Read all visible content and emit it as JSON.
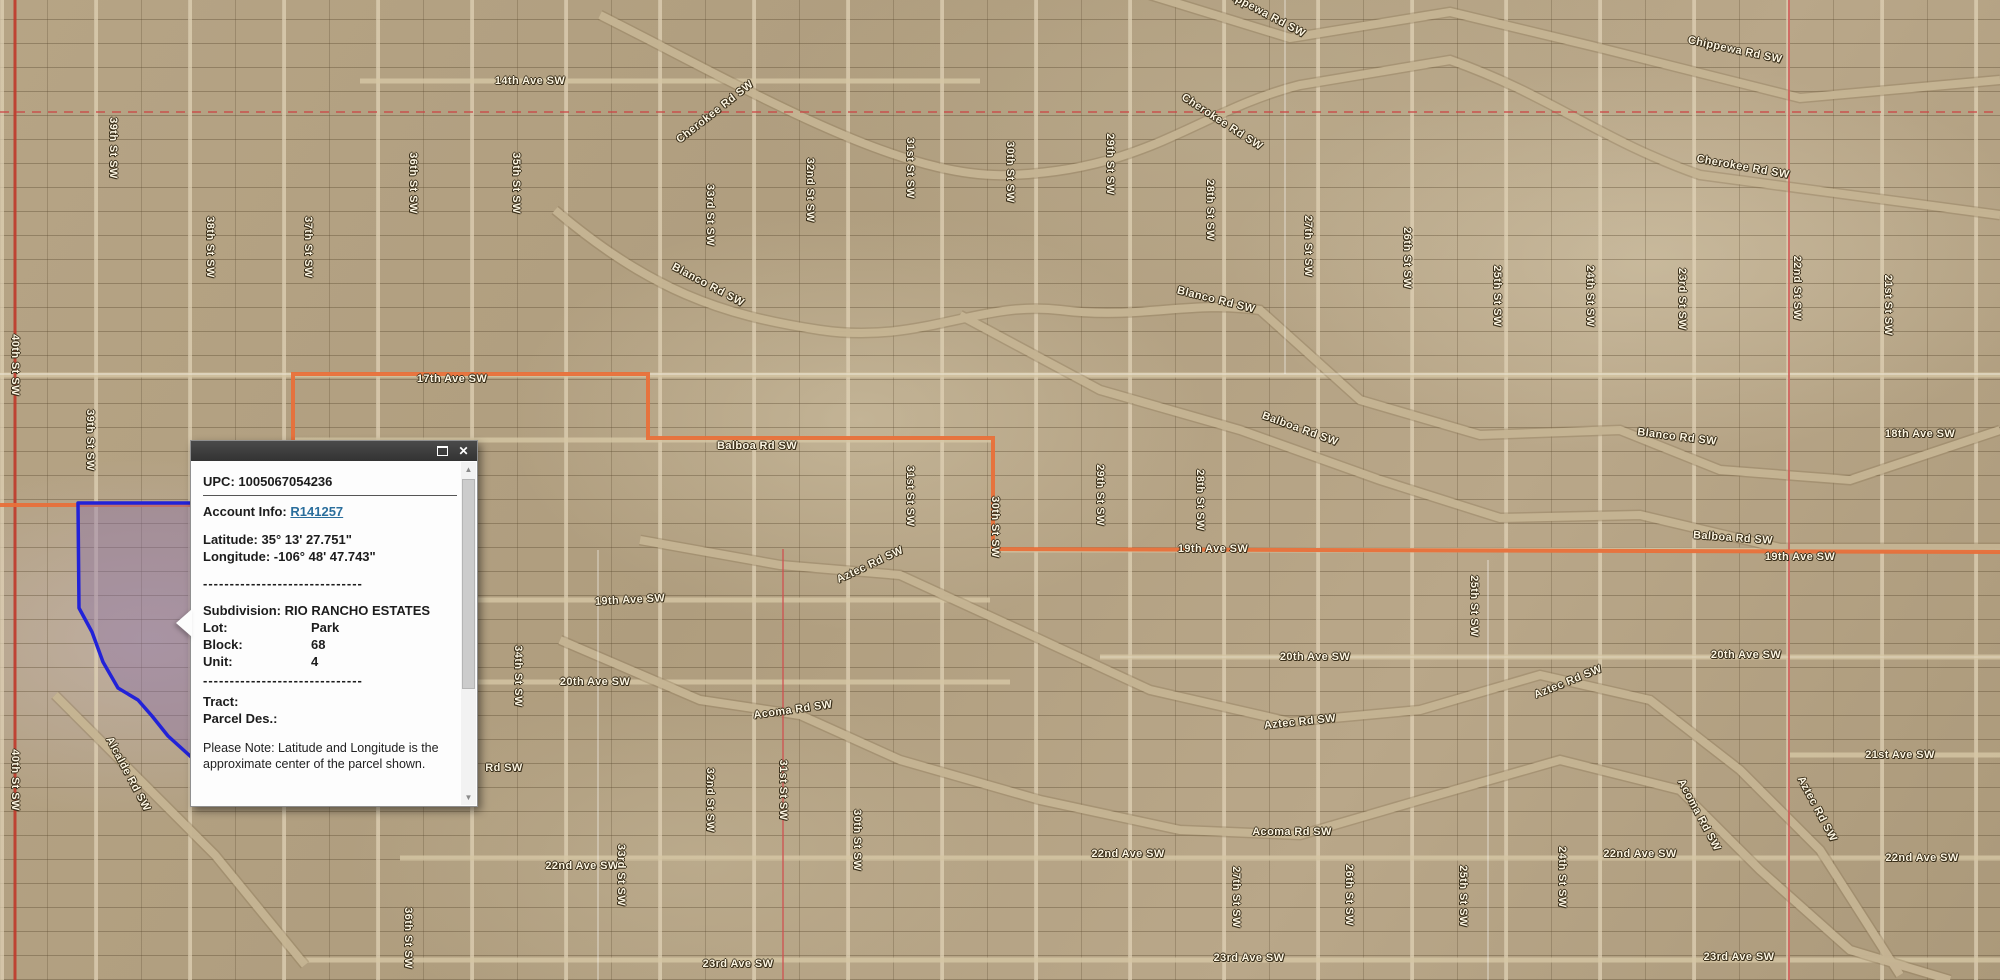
{
  "map": {
    "colors": {
      "parcel_outline_blue": "#2222d8",
      "parcel_fill_purple": "rgba(138,112,168,0.42)",
      "boundary_orange": "#e8703a",
      "section_line_red": "#cc4040",
      "road_red": "#c0392b",
      "label_text": "#fdf6e3"
    },
    "street_labels": [
      {
        "text": "39th St SW",
        "x": 113,
        "y": 148,
        "r": 90
      },
      {
        "text": "38th St SW",
        "x": 210,
        "y": 247,
        "r": 90
      },
      {
        "text": "37th St SW",
        "x": 308,
        "y": 247,
        "r": 90
      },
      {
        "text": "36th St SW",
        "x": 413,
        "y": 183,
        "r": 90
      },
      {
        "text": "35th St SW",
        "x": 516,
        "y": 183,
        "r": 90
      },
      {
        "text": "33rd St SW",
        "x": 710,
        "y": 215,
        "r": 90
      },
      {
        "text": "32nd St SW",
        "x": 810,
        "y": 190,
        "r": 90
      },
      {
        "text": "31st St SW",
        "x": 910,
        "y": 168,
        "r": 90
      },
      {
        "text": "30th St SW",
        "x": 1010,
        "y": 172,
        "r": 90
      },
      {
        "text": "29th St SW",
        "x": 1110,
        "y": 164,
        "r": 90
      },
      {
        "text": "28th St SW",
        "x": 1210,
        "y": 210,
        "r": 90
      },
      {
        "text": "27th St SW",
        "x": 1308,
        "y": 246,
        "r": 90
      },
      {
        "text": "26th St SW",
        "x": 1407,
        "y": 258,
        "r": 90
      },
      {
        "text": "25th St SW",
        "x": 1497,
        "y": 296,
        "r": 90
      },
      {
        "text": "24th St SW",
        "x": 1590,
        "y": 296,
        "r": 90
      },
      {
        "text": "23rd St SW",
        "x": 1682,
        "y": 299,
        "r": 90
      },
      {
        "text": "22nd St SW",
        "x": 1797,
        "y": 288,
        "r": 90
      },
      {
        "text": "21st St SW",
        "x": 1888,
        "y": 305,
        "r": 90
      },
      {
        "text": "40th St SW",
        "x": 15,
        "y": 780,
        "r": 90
      },
      {
        "text": "40th St SW",
        "x": 15,
        "y": 365,
        "r": 90
      },
      {
        "text": "39th St SW",
        "x": 90,
        "y": 440,
        "r": 90
      },
      {
        "text": "14th Ave SW",
        "x": 530,
        "y": 81,
        "r": 0
      },
      {
        "text": "Cherokee Rd SW",
        "x": 715,
        "y": 112,
        "r": -38
      },
      {
        "text": "Cherokee Rd SW",
        "x": 1222,
        "y": 122,
        "r": 33
      },
      {
        "text": "Cherokee Rd SW",
        "x": 1743,
        "y": 167,
        "r": 10
      },
      {
        "text": "Chippewa Rd SW",
        "x": 1262,
        "y": 12,
        "r": 28
      },
      {
        "text": "Chippewa Rd SW",
        "x": 1735,
        "y": 50,
        "r": 12
      },
      {
        "text": "Blanco Rd SW",
        "x": 708,
        "y": 285,
        "r": 28
      },
      {
        "text": "Blanco Rd SW",
        "x": 1216,
        "y": 300,
        "r": 14
      },
      {
        "text": "Blanco Rd SW",
        "x": 1677,
        "y": 437,
        "r": 7
      },
      {
        "text": "17th Ave SW",
        "x": 452,
        "y": 379,
        "r": 0
      },
      {
        "text": "Balboa Rd SW",
        "x": 757,
        "y": 446,
        "r": 0
      },
      {
        "text": "Balboa Rd SW",
        "x": 1300,
        "y": 429,
        "r": 20
      },
      {
        "text": "Balboa Rd SW",
        "x": 1733,
        "y": 538,
        "r": 4
      },
      {
        "text": "18th Ave SW",
        "x": 1920,
        "y": 434,
        "r": 0
      },
      {
        "text": "19th Ave SW",
        "x": 1213,
        "y": 549,
        "r": 0
      },
      {
        "text": "19th Ave SW",
        "x": 1800,
        "y": 557,
        "r": 0
      },
      {
        "text": "19th Ave SW",
        "x": 630,
        "y": 600,
        "r": -3
      },
      {
        "text": "Aztec Rd SW",
        "x": 870,
        "y": 565,
        "r": -25
      },
      {
        "text": "20th Ave SW",
        "x": 595,
        "y": 682,
        "r": 0
      },
      {
        "text": "20th Ave SW",
        "x": 1315,
        "y": 657,
        "r": 0
      },
      {
        "text": "20th Ave SW",
        "x": 1746,
        "y": 655,
        "r": 0
      },
      {
        "text": "Acoma Rd SW",
        "x": 793,
        "y": 710,
        "r": -8
      },
      {
        "text": "Aztec Rd SW",
        "x": 1300,
        "y": 722,
        "r": -6
      },
      {
        "text": "Aztec Rd SW",
        "x": 1568,
        "y": 682,
        "r": -22
      },
      {
        "text": "Aztec Rd SW",
        "x": 1817,
        "y": 809,
        "r": 62
      },
      {
        "text": "Acoma Rd SW",
        "x": 1292,
        "y": 832,
        "r": 0
      },
      {
        "text": "Acoma Rd SW",
        "x": 1699,
        "y": 815,
        "r": 62
      },
      {
        "text": "21st Ave SW",
        "x": 1900,
        "y": 755,
        "r": 0
      },
      {
        "text": "22nd Ave SW",
        "x": 582,
        "y": 866,
        "r": 0
      },
      {
        "text": "22nd Ave SW",
        "x": 1128,
        "y": 854,
        "r": 0
      },
      {
        "text": "22nd Ave SW",
        "x": 1640,
        "y": 854,
        "r": 0
      },
      {
        "text": "22nd Ave SW",
        "x": 1922,
        "y": 858,
        "r": 0
      },
      {
        "text": "23rd Ave SW",
        "x": 738,
        "y": 964,
        "r": 0
      },
      {
        "text": "23rd Ave SW",
        "x": 1249,
        "y": 958,
        "r": 0
      },
      {
        "text": "23rd Ave SW",
        "x": 1739,
        "y": 957,
        "r": 0
      },
      {
        "text": "Alcalde Rd SW",
        "x": 128,
        "y": 774,
        "r": 62
      },
      {
        "text": "Rd SW",
        "x": 504,
        "y": 768,
        "r": 0
      },
      {
        "text": "34th St SW",
        "x": 518,
        "y": 676,
        "r": 90
      },
      {
        "text": "31st St SW",
        "x": 910,
        "y": 496,
        "r": 90
      },
      {
        "text": "30th St SW",
        "x": 995,
        "y": 527,
        "r": 90
      },
      {
        "text": "29th St SW",
        "x": 1100,
        "y": 495,
        "r": 90
      },
      {
        "text": "28th St SW",
        "x": 1200,
        "y": 500,
        "r": 90
      },
      {
        "text": "33rd St SW",
        "x": 621,
        "y": 875,
        "r": 90
      },
      {
        "text": "32nd St SW",
        "x": 710,
        "y": 800,
        "r": 90
      },
      {
        "text": "31st St SW",
        "x": 783,
        "y": 790,
        "r": 90
      },
      {
        "text": "30th St SW",
        "x": 857,
        "y": 840,
        "r": 90
      },
      {
        "text": "36th St SW",
        "x": 408,
        "y": 938,
        "r": 90
      },
      {
        "text": "27th St SW",
        "x": 1236,
        "y": 897,
        "r": 90
      },
      {
        "text": "26th St SW",
        "x": 1349,
        "y": 895,
        "r": 90
      },
      {
        "text": "25th St SW",
        "x": 1463,
        "y": 896,
        "r": 90
      },
      {
        "text": "24th St SW",
        "x": 1562,
        "y": 877,
        "r": 90
      },
      {
        "text": "25th St SW",
        "x": 1474,
        "y": 606,
        "r": 90
      }
    ]
  },
  "popup": {
    "upc_label": "UPC:",
    "upc_value": "1005067054236",
    "account_label": "Account Info:",
    "account_link": "R141257",
    "latitude_label": "Latitude:",
    "latitude_value": "35° 13' 27.751\"",
    "longitude_label": "Longitude:",
    "longitude_value": "-106° 48' 47.743\"",
    "dashes": "------------------------------",
    "subdivision_label": "Subdivision:",
    "subdivision_value": "RIO RANCHO ESTATES",
    "lot_label": "Lot:",
    "lot_value": "Park",
    "block_label": "Block:",
    "block_value": "68",
    "unit_label": "Unit:",
    "unit_value": "4",
    "tract_label": "Tract:",
    "parcel_des_label": "Parcel Des.:",
    "note": "Please Note: Latitude and Longitude is the approximate center of the parcel shown."
  }
}
